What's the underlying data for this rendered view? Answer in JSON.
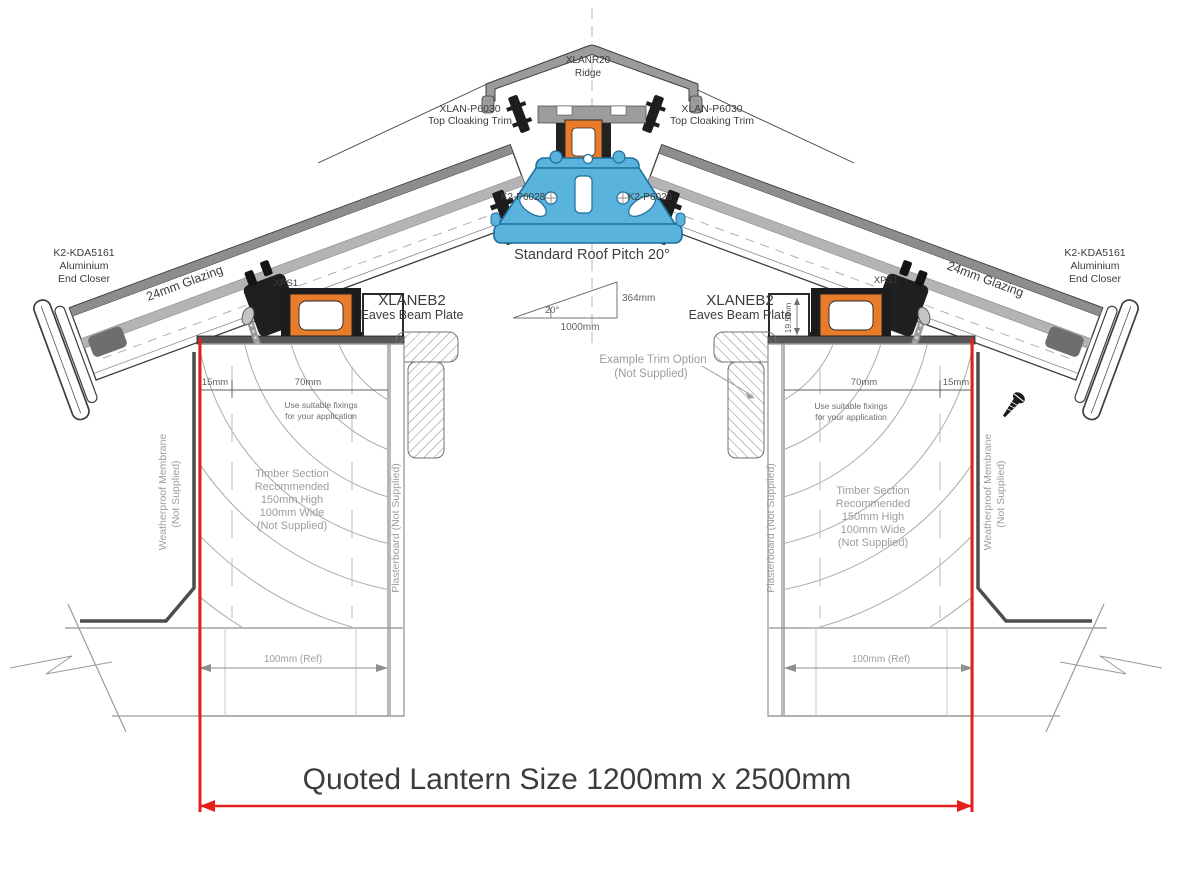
{
  "colors": {
    "accent_red": "#e3201c",
    "thermal_break_orange": "#e87c2a",
    "ridge_beam_blue": "#5ab3dd"
  },
  "labels": {
    "ridge": [
      "XLANR20",
      "Ridge"
    ],
    "top_cloaking_trim": [
      "XLAN-P6030",
      "Top Cloaking Trim"
    ],
    "ridge_bolt_code": "K2-P6028",
    "roof_pitch": "Standard Roof Pitch 20°",
    "pitch_triangle": {
      "angle": "20°",
      "run": "1000mm",
      "rise": "364mm"
    },
    "eaves_beam": [
      "XLANEB2",
      "Eaves Beam Plate"
    ],
    "glazing_support": "XPS1",
    "end_closer": [
      "K2-KDA5161",
      "Aluminium",
      "End Closer"
    ],
    "glazing": "24mm Glazing",
    "trim_option": [
      "Example Trim Option",
      "(Not Supplied)"
    ],
    "fixing_note": [
      "Use suitable fixings",
      "for your application"
    ],
    "timber_note": [
      "Timber Section",
      "Recommended",
      "150mm High",
      "100mm Wide",
      "(Not Supplied)"
    ],
    "membrane_note": [
      "Weatherproof Membrane",
      "(Not Supplied)"
    ],
    "plasterboard_note": "Plasterboard (Not Supplied)",
    "dimensions": {
      "offset": "15mm",
      "timber_fix": "70mm",
      "upstand": "19.5mm",
      "ref": "100mm (Ref)"
    },
    "quoted_size": "Quoted Lantern Size 1200mm x 2500mm"
  }
}
